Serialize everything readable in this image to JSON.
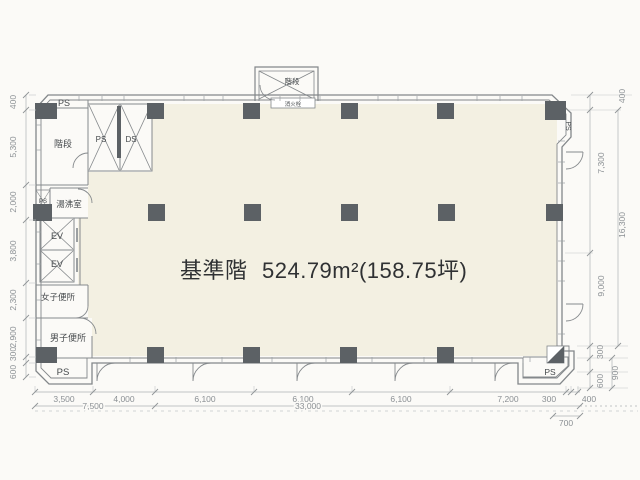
{
  "title": {
    "floor_name": "基準階",
    "area": "524.79m²(158.75坪)"
  },
  "rooms": {
    "ps_top_left": "PS",
    "stairs_left": "階段",
    "ps_shaft": "PS",
    "ds_shaft": "DS",
    "kitchenette": "湯沸室",
    "ps_kitchenette": "PS",
    "elevator_1": "EV",
    "elevator_2": "EV",
    "womens_toilet": "女子便所",
    "mens_toilet": "男子便所",
    "ps_bottom_left": "PS",
    "stairs_top": "階段",
    "fire_hydrant": "消火栓",
    "ps_top_right": "PS",
    "ps_bottom_right": "PS"
  },
  "dimensions": {
    "left": [
      "400",
      "5,300",
      "2,000",
      "3,800",
      "2,300",
      "2,900",
      "300",
      "600"
    ],
    "right": [
      "400",
      "7,300",
      "16,300",
      "9,000",
      "300",
      "900",
      "600"
    ],
    "bottom": [
      "3,500",
      "4,000",
      "6,100",
      "6,100",
      "6,100",
      "7,200",
      "300",
      "400"
    ],
    "bottom_totals": [
      "7,500",
      "33,000",
      "700"
    ]
  },
  "colors": {
    "floor": "#f3f0e2",
    "column": "#5c6165",
    "wall": "#83878a",
    "dim_text": "#8b9094",
    "background": "#fbfaf7"
  }
}
